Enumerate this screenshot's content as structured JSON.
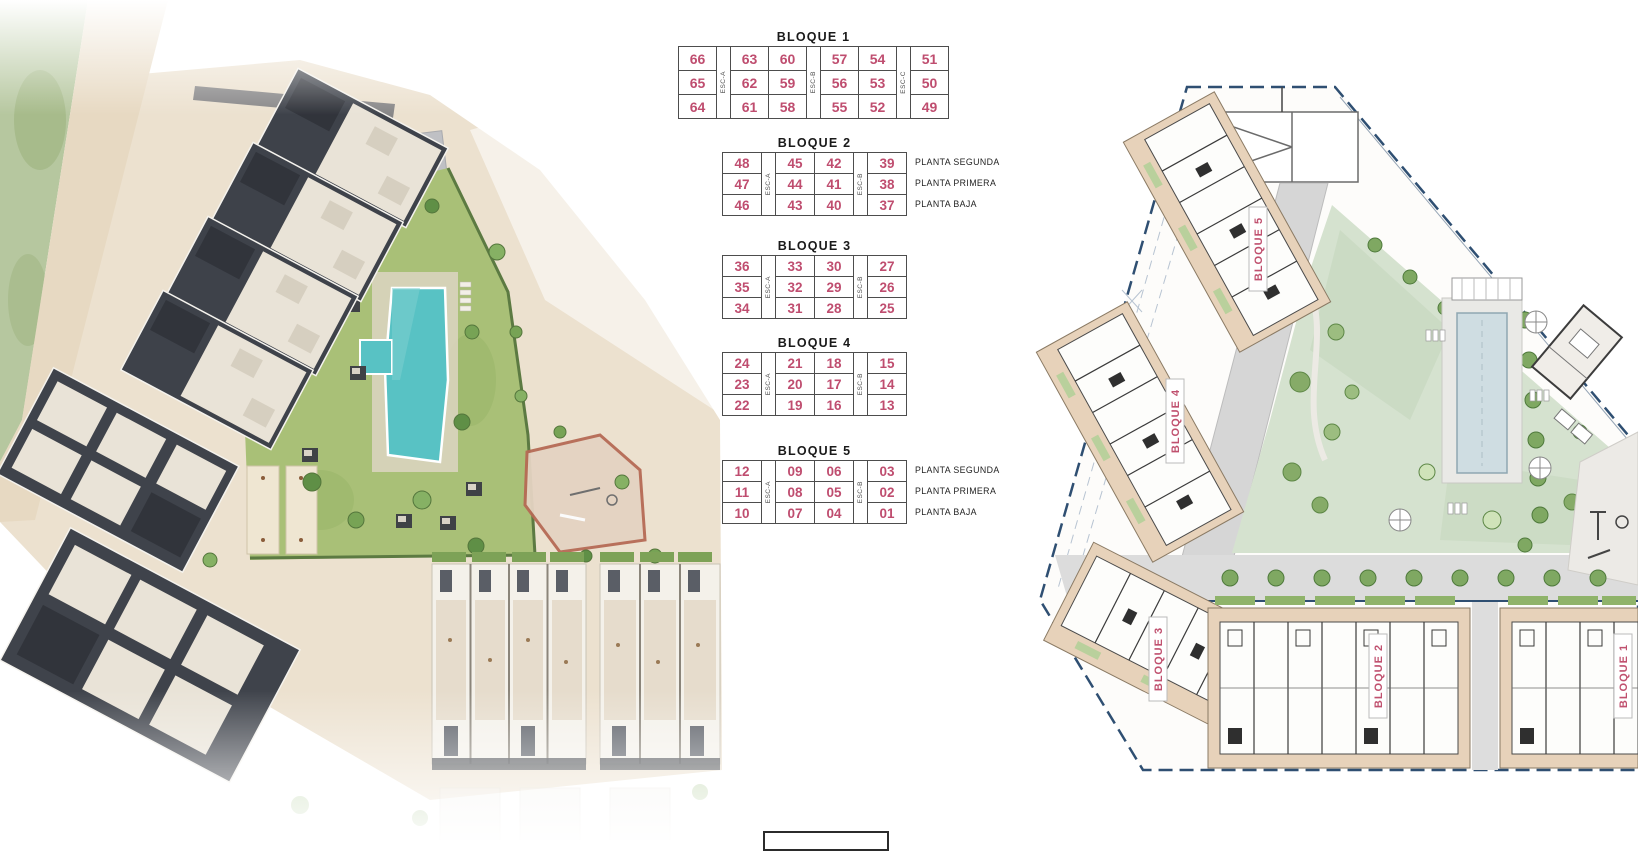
{
  "tables": [
    {
      "title": "BLOQUE 1",
      "esc_labels": [
        "ESC-A",
        "ESC-B",
        "ESC-C"
      ],
      "rows": [
        [
          "66",
          "63",
          "60",
          "57",
          "54",
          "51"
        ],
        [
          "65",
          "62",
          "59",
          "56",
          "53",
          "50"
        ],
        [
          "64",
          "61",
          "58",
          "55",
          "52",
          "49"
        ]
      ],
      "floor_labels": []
    },
    {
      "title": "BLOQUE 2",
      "esc_labels": [
        "ESC-A",
        "ESC-B"
      ],
      "rows": [
        [
          "48",
          "45",
          "42",
          "39"
        ],
        [
          "47",
          "44",
          "41",
          "38"
        ],
        [
          "46",
          "43",
          "40",
          "37"
        ]
      ],
      "floor_labels": [
        "PLANTA SEGUNDA",
        "PLANTA PRIMERA",
        "PLANTA BAJA"
      ]
    },
    {
      "title": "BLOQUE 3",
      "esc_labels": [
        "ESC-A",
        "ESC-B"
      ],
      "rows": [
        [
          "36",
          "33",
          "30",
          "27"
        ],
        [
          "35",
          "32",
          "29",
          "26"
        ],
        [
          "34",
          "31",
          "28",
          "25"
        ]
      ],
      "floor_labels": []
    },
    {
      "title": "BLOQUE 4",
      "esc_labels": [
        "ESC-A",
        "ESC-B"
      ],
      "rows": [
        [
          "24",
          "21",
          "18",
          "15"
        ],
        [
          "23",
          "20",
          "17",
          "14"
        ],
        [
          "22",
          "19",
          "16",
          "13"
        ]
      ],
      "floor_labels": []
    },
    {
      "title": "BLOQUE 5",
      "esc_labels": [
        "ESC-A",
        "ESC-B"
      ],
      "rows": [
        [
          "12",
          "09",
          "06",
          "03"
        ],
        [
          "11",
          "08",
          "05",
          "02"
        ],
        [
          "10",
          "07",
          "04",
          "01"
        ]
      ],
      "floor_labels": [
        "PLANTA SEGUNDA",
        "PLANTA PRIMERA",
        "PLANTA BAJA"
      ]
    }
  ],
  "site_plan": {
    "block_labels": [
      "BLOQUE 5",
      "BLOQUE 4",
      "BLOQUE 3",
      "BLOQUE 2",
      "BLOQUE 1"
    ]
  },
  "colors": {
    "unit_number": "#bf4d6f",
    "plan_block_label": "#c0516f",
    "boundary_dash": "#2f4f72",
    "pool_render": "#58c2c4",
    "lawn_render": "#a9c077",
    "lawn_plan": "#d5e2cf",
    "building_dark": "#3f434b",
    "building_tan": "#e7d2ba"
  }
}
